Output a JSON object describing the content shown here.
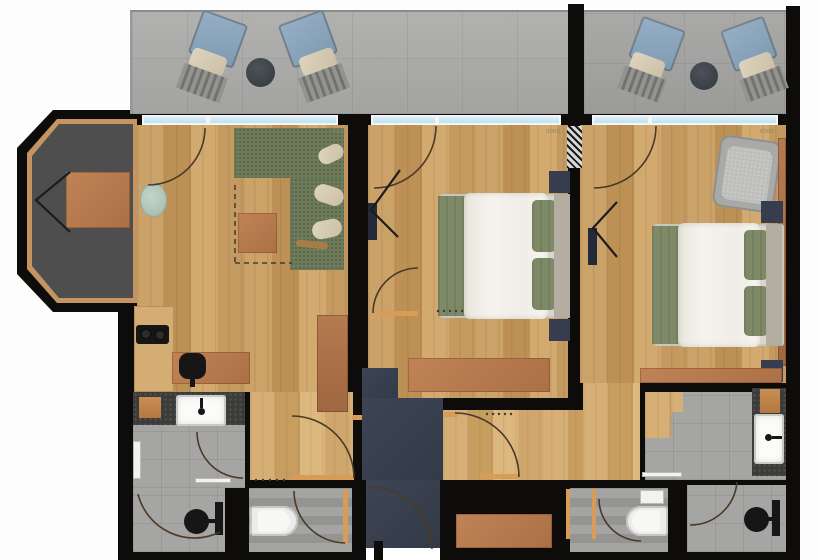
{
  "document": {
    "kind": "architectural-floor-plan",
    "units_text_visible": false
  },
  "palette": {
    "wall": "#0d0c0b",
    "wood_floor": "#c79e64",
    "wood_hall": "#cfa76d",
    "balcony_concrete": "#a8a8a6",
    "bathroom_tile": "#a3a3a1",
    "entry_floor": "#3a4150",
    "bay_floor": "#4e4e4e",
    "terracotta_furniture": "#b87c55",
    "sofa_green": "#6f7c5b",
    "bed_blanket_green": "#7e8a67",
    "bed_duvet": "#f2f0e9",
    "nightstand_navy": "#353d4f",
    "lounge_chair_blue": "#8ba6bd",
    "window_glass": "#cfe9f6",
    "door_wood": "#d89c57",
    "vanity_mosaic": "#3b3b39",
    "door_arc": "#4a3a26"
  },
  "dimension_labels": [
    {
      "text": "0000",
      "x": 331,
      "y": 133
    },
    {
      "text": "0000",
      "x": 546,
      "y": 133
    },
    {
      "text": "0000",
      "x": 760,
      "y": 133
    }
  ],
  "shapes": [
    {
      "n": "outer-wall",
      "c": "wall",
      "x": 118,
      "y": 110,
      "w": 682,
      "h": 450
    },
    {
      "n": "bay-window-wall",
      "c": "wall",
      "x": 17,
      "y": 110,
      "w": 120,
      "h": 202,
      "clip": "polygon(36px 0px,120px 0px,120px 202px,36px 202px,0px 164px,0px 38px)"
    },
    {
      "n": "bay-window-frame",
      "c": "bayframe",
      "x": 27,
      "y": 119,
      "w": 110,
      "h": 184,
      "clip": "polygon(30px 0px,110px 0px,110px 184px,30px 184px,0px 150px,0px 34px)"
    },
    {
      "n": "bay-window-floor",
      "c": "bayfloor",
      "x": 32,
      "y": 124,
      "w": 101,
      "h": 174,
      "clip": "polygon(27px 0px,101px 0px,101px 174px,27px 174px,0px 142px,0px 32px)"
    },
    {
      "n": "balcony-left-floor",
      "c": "concrete",
      "x": 130,
      "y": 10,
      "w": 438,
      "h": 102,
      "css": "border-top:2px solid #8a8a88;border-left:2px solid #99999b"
    },
    {
      "n": "balcony-right-floor",
      "c": "concrete2",
      "x": 584,
      "y": 10,
      "w": 202,
      "h": 102,
      "css": "border-top:2px solid #8a8a88"
    },
    {
      "n": "balcony-divider-wall",
      "c": "wall",
      "x": 568,
      "y": 4,
      "w": 16,
      "h": 116
    },
    {
      "n": "balcony-outer-wall",
      "c": "wall",
      "x": 786,
      "y": 6,
      "w": 14,
      "h": 114
    },
    {
      "n": "lounge-chair-back",
      "c": "blue",
      "x": 194,
      "y": 16,
      "w": 48,
      "h": 46,
      "rot": 20,
      "r": "4px"
    },
    {
      "n": "lounge-chair-cushion",
      "c": "cushionc",
      "x": 190,
      "y": 52,
      "w": 36,
      "h": 20,
      "rot": 20,
      "r": "5px"
    },
    {
      "n": "lounge-chair-slats",
      "c": "slats",
      "x": 179,
      "y": 70,
      "w": 46,
      "h": 26,
      "rot": 20
    },
    {
      "n": "balcony-table",
      "c": "tabledark",
      "x": 246,
      "y": 58,
      "w": 29,
      "h": 29,
      "r": "50%"
    },
    {
      "n": "lounge-chair-back",
      "c": "blue",
      "x": 284,
      "y": 16,
      "w": 48,
      "h": 46,
      "rot": -20,
      "r": "4px"
    },
    {
      "n": "lounge-chair-cushion",
      "c": "cushionc",
      "x": 300,
      "y": 52,
      "w": 36,
      "h": 20,
      "rot": -20,
      "r": "5px"
    },
    {
      "n": "lounge-chair-slats",
      "c": "slats",
      "x": 301,
      "y": 70,
      "w": 46,
      "h": 26,
      "rot": -20
    },
    {
      "n": "lounge-chair-back",
      "c": "blue",
      "x": 634,
      "y": 22,
      "w": 46,
      "h": 44,
      "rot": 20,
      "r": "4px"
    },
    {
      "n": "lounge-chair-cushion",
      "c": "cushionc",
      "x": 630,
      "y": 56,
      "w": 34,
      "h": 20,
      "rot": 20,
      "r": "5px"
    },
    {
      "n": "lounge-chair-slats",
      "c": "slats",
      "x": 620,
      "y": 72,
      "w": 44,
      "h": 24,
      "rot": 20
    },
    {
      "n": "balcony-table",
      "c": "tabledark",
      "x": 690,
      "y": 62,
      "w": 28,
      "h": 28,
      "r": "50%"
    },
    {
      "n": "lounge-chair-back",
      "c": "blue",
      "x": 726,
      "y": 22,
      "w": 46,
      "h": 44,
      "rot": -20,
      "r": "4px"
    },
    {
      "n": "lounge-chair-cushion",
      "c": "cushionc",
      "x": 740,
      "y": 56,
      "w": 34,
      "h": 20,
      "rot": -20,
      "r": "5px"
    },
    {
      "n": "lounge-chair-slats",
      "c": "slats",
      "x": 742,
      "y": 72,
      "w": 44,
      "h": 24,
      "rot": -20
    },
    {
      "n": "living-room-floor",
      "c": "wood",
      "x": 137,
      "y": 125,
      "w": 211,
      "h": 267
    },
    {
      "n": "hallway-left-floor",
      "c": "wood2",
      "x": 250,
      "y": 392,
      "w": 103,
      "h": 88
    },
    {
      "n": "bedroom-1-floor",
      "c": "wood",
      "x": 368,
      "y": 125,
      "w": 200,
      "h": 273
    },
    {
      "n": "bedroom-2-floor",
      "c": "wood",
      "x": 580,
      "y": 125,
      "w": 206,
      "h": 258
    },
    {
      "n": "bedroom-2-doorway-floor",
      "c": "wood2",
      "x": 583,
      "y": 383,
      "w": 57,
      "h": 97
    },
    {
      "n": "hallway-center-floor",
      "c": "wood2",
      "x": 443,
      "y": 410,
      "w": 140,
      "h": 70
    },
    {
      "n": "bathroom-2-floor",
      "c": "tile",
      "x": 645,
      "y": 392,
      "w": 141,
      "h": 88
    },
    {
      "n": "bathroom-2-wood-edge",
      "c": "wood2",
      "x": 645,
      "y": 392,
      "w": 26,
      "h": 46
    },
    {
      "n": "bathroom-2-wood-edge",
      "c": "wood2",
      "x": 671,
      "y": 392,
      "w": 12,
      "h": 20
    },
    {
      "n": "bathroom-1-vanity-counter",
      "c": "mosaic",
      "x": 133,
      "y": 392,
      "w": 112,
      "h": 33
    },
    {
      "n": "bathroom-1-floor",
      "c": "tile",
      "x": 133,
      "y": 425,
      "w": 112,
      "h": 63
    },
    {
      "n": "bathroom-1-floor",
      "c": "tile",
      "x": 133,
      "y": 488,
      "w": 92,
      "h": 64
    },
    {
      "n": "wc-1-floor",
      "c": "tile2",
      "x": 249,
      "y": 488,
      "w": 103,
      "h": 64
    },
    {
      "n": "wc-2-floor",
      "c": "tile2",
      "x": 570,
      "y": 488,
      "w": 98,
      "h": 64
    },
    {
      "n": "shower-room-floor",
      "c": "tile",
      "x": 687,
      "y": 485,
      "w": 99,
      "h": 67
    },
    {
      "n": "entry-hall-floor",
      "c": "navy",
      "x": 362,
      "y": 368,
      "w": 36,
      "h": 30
    },
    {
      "n": "entry-hall-floor",
      "c": "navy",
      "x": 362,
      "y": 398,
      "w": 81,
      "h": 82
    },
    {
      "n": "entry-hall-floor",
      "c": "navy",
      "x": 366,
      "y": 480,
      "w": 74,
      "h": 68
    },
    {
      "n": "entrance-opening",
      "c": "white",
      "x": 366,
      "y": 548,
      "w": 74,
      "h": 12
    },
    {
      "n": "entrance-door-leaf",
      "c": "wall",
      "x": 374,
      "y": 541,
      "w": 9,
      "h": 19
    },
    {
      "n": "hall-closet-bench",
      "c": "terr",
      "x": 456,
      "y": 514,
      "w": 96,
      "h": 34
    },
    {
      "n": "window-frame",
      "c": "winframe",
      "x": 142,
      "y": 115,
      "w": 196,
      "h": 10
    },
    {
      "n": "window-glass",
      "c": "glass",
      "x": 144,
      "y": 117,
      "w": 62,
      "h": 6
    },
    {
      "n": "window-glass",
      "c": "glass",
      "x": 210,
      "y": 117,
      "w": 126,
      "h": 6
    },
    {
      "n": "window-frame",
      "c": "winframe",
      "x": 371,
      "y": 115,
      "w": 190,
      "h": 10
    },
    {
      "n": "window-glass",
      "c": "glass",
      "x": 373,
      "y": 117,
      "w": 62,
      "h": 6
    },
    {
      "n": "window-glass",
      "c": "glass",
      "x": 439,
      "y": 117,
      "w": 120,
      "h": 6
    },
    {
      "n": "window-frame",
      "c": "winframe",
      "x": 592,
      "y": 115,
      "w": 186,
      "h": 10
    },
    {
      "n": "window-glass",
      "c": "glass",
      "x": 594,
      "y": 117,
      "w": 54,
      "h": 6
    },
    {
      "n": "window-glass",
      "c": "glass",
      "x": 652,
      "y": 117,
      "w": 124,
      "h": 6
    },
    {
      "n": "hatched-wall-section",
      "c": "hatch",
      "x": 567,
      "y": 126,
      "w": 15,
      "h": 42
    },
    {
      "n": "sofa-section",
      "c": "green",
      "x": 234,
      "y": 128,
      "w": 110,
      "h": 50
    },
    {
      "n": "sofa-section",
      "c": "green",
      "x": 290,
      "y": 178,
      "w": 54,
      "h": 92
    },
    {
      "n": "sofa-pillow",
      "c": "cushionc",
      "x": 318,
      "y": 146,
      "w": 26,
      "h": 16,
      "rot": -25,
      "r": "8px"
    },
    {
      "n": "sofa-pillow",
      "c": "cushionc",
      "x": 314,
      "y": 186,
      "w": 30,
      "h": 18,
      "rot": 18,
      "r": "9px"
    },
    {
      "n": "sofa-pillow",
      "c": "cushionc",
      "x": 312,
      "y": 220,
      "w": 30,
      "h": 18,
      "rot": -12,
      "r": "9px"
    },
    {
      "n": "sofa-throw",
      "c": "stick",
      "x": 296,
      "y": 241,
      "w": 32,
      "h": 7,
      "rot": 6,
      "r": "3px"
    },
    {
      "n": "coffee-table",
      "c": "terr",
      "x": 238,
      "y": 213,
      "w": 39,
      "h": 40
    },
    {
      "n": "ottoman",
      "c": "pale",
      "x": 140,
      "y": 183,
      "w": 27,
      "h": 34,
      "r": "50%"
    },
    {
      "n": "kitchen-counter",
      "c": "woodlight",
      "x": 134,
      "y": 306,
      "w": 40,
      "h": 86
    },
    {
      "n": "stove",
      "c": "dark",
      "x": 136,
      "y": 325,
      "w": 33,
      "h": 19,
      "r": "3px"
    },
    {
      "n": "stove-burner",
      "c": "burner",
      "x": 140,
      "y": 328,
      "w": 12,
      "h": 12,
      "r": "50%"
    },
    {
      "n": "stove-burner",
      "c": "burner",
      "x": 154,
      "y": 329,
      "w": 12,
      "h": 12,
      "r": "50%"
    },
    {
      "n": "desk",
      "c": "terr",
      "x": 172,
      "y": 352,
      "w": 78,
      "h": 32
    },
    {
      "n": "desk-chair",
      "c": "dark",
      "x": 179,
      "y": 353,
      "w": 27,
      "h": 26,
      "r": "9px"
    },
    {
      "n": "desk-chair-stem",
      "c": "dark",
      "x": 190,
      "y": 378,
      "w": 5,
      "h": 9
    },
    {
      "n": "bay-desk",
      "c": "terr",
      "x": 66,
      "y": 172,
      "w": 64,
      "h": 56
    },
    {
      "n": "wardrobe",
      "c": "terr2",
      "x": 317,
      "y": 315,
      "w": 31,
      "h": 97
    },
    {
      "n": "nightstand",
      "c": "nightstand",
      "x": 549,
      "y": 171,
      "w": 21,
      "h": 22
    },
    {
      "n": "nightstand",
      "c": "nightstand",
      "x": 549,
      "y": 319,
      "w": 21,
      "h": 22
    },
    {
      "n": "bed-frame",
      "c": "bedframe",
      "x": 440,
      "y": 194,
      "w": 130,
      "h": 124,
      "r": "3px"
    },
    {
      "n": "bed-foot-blanket",
      "c": "greenbed",
      "x": 438,
      "y": 196,
      "w": 30,
      "h": 120
    },
    {
      "n": "bed-duvet",
      "c": "duvet",
      "x": 464,
      "y": 193,
      "w": 84,
      "h": 126,
      "r": "6px"
    },
    {
      "n": "bed-pillow",
      "c": "greenbed",
      "x": 532,
      "y": 200,
      "w": 24,
      "h": 52,
      "r": "5px"
    },
    {
      "n": "bed-pillow",
      "c": "greenbed",
      "x": 532,
      "y": 258,
      "w": 24,
      "h": 52,
      "r": "5px"
    },
    {
      "n": "bed-headboard",
      "c": "headboard",
      "x": 554,
      "y": 194,
      "w": 16,
      "h": 124
    },
    {
      "n": "wall-tv",
      "c": "tv",
      "x": 368,
      "y": 203,
      "w": 9,
      "h": 37
    },
    {
      "n": "luggage-bench",
      "c": "terr",
      "x": 408,
      "y": 358,
      "w": 142,
      "h": 34
    },
    {
      "n": "armchair",
      "c": "armchair",
      "x": 716,
      "y": 138,
      "w": 62,
      "h": 72,
      "rot": 8,
      "r": "10px"
    },
    {
      "n": "armchair-cushion",
      "c": "armchair2",
      "x": 724,
      "y": 148,
      "w": 46,
      "h": 54,
      "rot": 8,
      "r": "8px"
    },
    {
      "n": "wardrobe-rail",
      "c": "terr2",
      "x": 778,
      "y": 138,
      "w": 8,
      "h": 228
    },
    {
      "n": "nightstand",
      "c": "nightstand",
      "x": 761,
      "y": 201,
      "w": 22,
      "h": 22
    },
    {
      "n": "nightstand",
      "c": "nightstand",
      "x": 761,
      "y": 360,
      "w": 22,
      "h": 22
    },
    {
      "n": "bed-frame",
      "c": "bedframe",
      "x": 654,
      "y": 224,
      "w": 130,
      "h": 122,
      "r": "3px"
    },
    {
      "n": "bed-foot-blanket",
      "c": "greenbed",
      "x": 652,
      "y": 226,
      "w": 30,
      "h": 118
    },
    {
      "n": "bed-duvet",
      "c": "duvet",
      "x": 678,
      "y": 223,
      "w": 82,
      "h": 124,
      "r": "6px"
    },
    {
      "n": "bed-pillow",
      "c": "greenbed",
      "x": 744,
      "y": 230,
      "w": 24,
      "h": 50,
      "r": "5px"
    },
    {
      "n": "bed-pillow",
      "c": "greenbed",
      "x": 744,
      "y": 286,
      "w": 24,
      "h": 50,
      "r": "5px"
    },
    {
      "n": "bed-headboard",
      "c": "headboard",
      "x": 766,
      "y": 224,
      "w": 16,
      "h": 122
    },
    {
      "n": "wall-tv",
      "c": "tv",
      "x": 588,
      "y": 228,
      "w": 9,
      "h": 37
    },
    {
      "n": "luggage-bench",
      "c": "terr",
      "x": 640,
      "y": 368,
      "w": 142,
      "h": 15
    },
    {
      "n": "towel-radiator",
      "c": "whitefix",
      "x": 133,
      "y": 441,
      "w": 8,
      "h": 38
    },
    {
      "n": "bath-stool",
      "c": "stool",
      "x": 139,
      "y": 397,
      "w": 22,
      "h": 21
    },
    {
      "n": "sink",
      "c": "sink",
      "x": 176,
      "y": 395,
      "w": 50,
      "h": 31,
      "r": "3px"
    },
    {
      "n": "sink-faucet",
      "c": "dark",
      "x": 198,
      "y": 408,
      "w": 7,
      "h": 7,
      "r": "50%"
    },
    {
      "n": "sink-faucet-stub",
      "c": "dark",
      "x": 200,
      "y": 398,
      "w": 3,
      "h": 10
    },
    {
      "n": "door-threshold",
      "c": "whitefix",
      "x": 195,
      "y": 478,
      "w": 36,
      "h": 5
    },
    {
      "n": "shower-head",
      "c": "dark",
      "x": 184,
      "y": 509,
      "w": 25,
      "h": 25,
      "r": "50%"
    },
    {
      "n": "shower-rail",
      "c": "dark",
      "x": 215,
      "y": 502,
      "w": 8,
      "h": 33
    },
    {
      "n": "shower-arm",
      "c": "dark",
      "x": 206,
      "y": 519,
      "w": 10,
      "h": 4
    },
    {
      "n": "toilet",
      "c": "toilet",
      "x": 250,
      "y": 506,
      "w": 48,
      "h": 30,
      "r": "4px 15px 15px 4px"
    },
    {
      "n": "toilet-seat",
      "c": "toiletseat",
      "x": 258,
      "y": 510,
      "w": 32,
      "h": 22,
      "r": "3px 11px 11px 3px"
    },
    {
      "n": "toilet-cistern",
      "c": "whitefix",
      "x": 640,
      "y": 490,
      "w": 24,
      "h": 14
    },
    {
      "n": "toilet",
      "c": "toilet",
      "x": 626,
      "y": 506,
      "w": 42,
      "h": 30,
      "r": "15px 4px 4px 15px"
    },
    {
      "n": "toilet-seat",
      "c": "toiletseat",
      "x": 632,
      "y": 510,
      "w": 28,
      "h": 22,
      "r": "11px 3px 3px 11px"
    },
    {
      "n": "wc-door-jamb",
      "c": "orange",
      "x": 566,
      "y": 489,
      "w": 4,
      "h": 50
    },
    {
      "n": "wc-door-jamb",
      "c": "orange",
      "x": 592,
      "y": 489,
      "w": 4,
      "h": 50
    },
    {
      "n": "bathroom-2-counter",
      "c": "mosaic",
      "x": 752,
      "y": 388,
      "w": 34,
      "h": 88
    },
    {
      "n": "towels",
      "c": "stool",
      "x": 760,
      "y": 389,
      "w": 20,
      "h": 24
    },
    {
      "n": "sink",
      "c": "sink",
      "x": 754,
      "y": 414,
      "w": 30,
      "h": 50,
      "r": "3px"
    },
    {
      "n": "sink-faucet",
      "c": "dark",
      "x": 765,
      "y": 434,
      "w": 7,
      "h": 7,
      "r": "50%"
    },
    {
      "n": "sink-faucet-stub",
      "c": "dark",
      "x": 772,
      "y": 436,
      "w": 10,
      "h": 3
    },
    {
      "n": "door-threshold",
      "c": "whitefix",
      "x": 642,
      "y": 472,
      "w": 40,
      "h": 5
    },
    {
      "n": "shower-head",
      "c": "dark",
      "x": 744,
      "y": 507,
      "w": 25,
      "h": 25,
      "r": "50%"
    },
    {
      "n": "shower-rail",
      "c": "dark",
      "x": 772,
      "y": 500,
      "w": 8,
      "h": 36
    },
    {
      "n": "shower-arm",
      "c": "dark",
      "x": 764,
      "y": 517,
      "w": 10,
      "h": 4
    },
    {
      "n": "door-leaf",
      "c": "orange",
      "x": 378,
      "y": 311,
      "w": 40,
      "h": 5
    },
    {
      "n": "door-jamb",
      "c": "orange",
      "x": 444,
      "y": 412,
      "w": 14,
      "h": 5
    },
    {
      "n": "door-leaf",
      "c": "orange",
      "x": 480,
      "y": 474,
      "w": 39,
      "h": 5
    },
    {
      "n": "door-leaf",
      "c": "orange",
      "x": 292,
      "y": 475,
      "w": 62,
      "h": 5
    },
    {
      "n": "door-leaf",
      "c": "orange",
      "x": 343,
      "y": 490,
      "w": 5,
      "h": 53
    },
    {
      "n": "door-jamb",
      "c": "orange",
      "x": 352,
      "y": 415,
      "w": 10,
      "h": 5
    }
  ],
  "svg": {
    "door_arcs": [
      {
        "n": "door-arc-living-balcony",
        "d": "M 205 128 A 57 57 0 0 1 148 185"
      },
      {
        "n": "door-arc-bedroom-1-balcony",
        "d": "M 436 126 A 62 62 0 0 1 374 188"
      },
      {
        "n": "door-arc-bedroom-2-balcony",
        "d": "M 656 126 A 62 62 0 0 1 594 188"
      },
      {
        "n": "door-arc-bedroom-1-entry",
        "d": "M 373 313 A 45 45 0 0 1 418 268"
      },
      {
        "n": "door-arc-hallway-center",
        "d": "M 455 413 A 64 64 0 0 1 519 477"
      },
      {
        "n": "door-arc-hallway-left",
        "d": "M 292 416 A 62 62 0 0 1 354 478"
      },
      {
        "n": "door-arc-bathroom-1",
        "d": "M 197 432 A 46 46 0 0 0 243 478"
      },
      {
        "n": "door-arc-shower-1",
        "d": "M 138 494 A 58 58 0 0 0 220 532"
      },
      {
        "n": "door-arc-entrance",
        "d": "M 432 549 A 62 62 0 0 0 370 487"
      },
      {
        "n": "door-arc-wc-1",
        "d": "M 294 491 A 52 52 0 0 0 345 543"
      },
      {
        "n": "door-arc-wc-2",
        "d": "M 599 499 A 42 42 0 0 0 641 541"
      },
      {
        "n": "door-arc-shower-2",
        "d": "M 690 525 A 47 47 0 0 0 737 482"
      }
    ],
    "chevrons": [
      {
        "n": "bay-chair",
        "pts": "70,172 36,200 70,232"
      },
      {
        "n": "tv-mount-arm",
        "pts": "400,170 371,210 398,237"
      },
      {
        "n": "tv-mount-arm",
        "pts": "617,202 593,228 617,257"
      }
    ],
    "dashed_lines": [
      {
        "n": "rug-outline-dashed",
        "d": "M 235 185 L 235 263"
      },
      {
        "n": "rug-outline-dashed",
        "d": "M 235 263 L 292 263"
      }
    ],
    "dot_rows": [
      {
        "n": "threshold-dots",
        "y": 311,
        "x0": 438,
        "step": 6,
        "count": 5
      },
      {
        "n": "threshold-dots",
        "y": 414,
        "x0": 487,
        "step": 6,
        "count": 5
      },
      {
        "n": "threshold-dots",
        "y": 480,
        "x0": 256,
        "step": 7,
        "count": 5
      }
    ]
  }
}
